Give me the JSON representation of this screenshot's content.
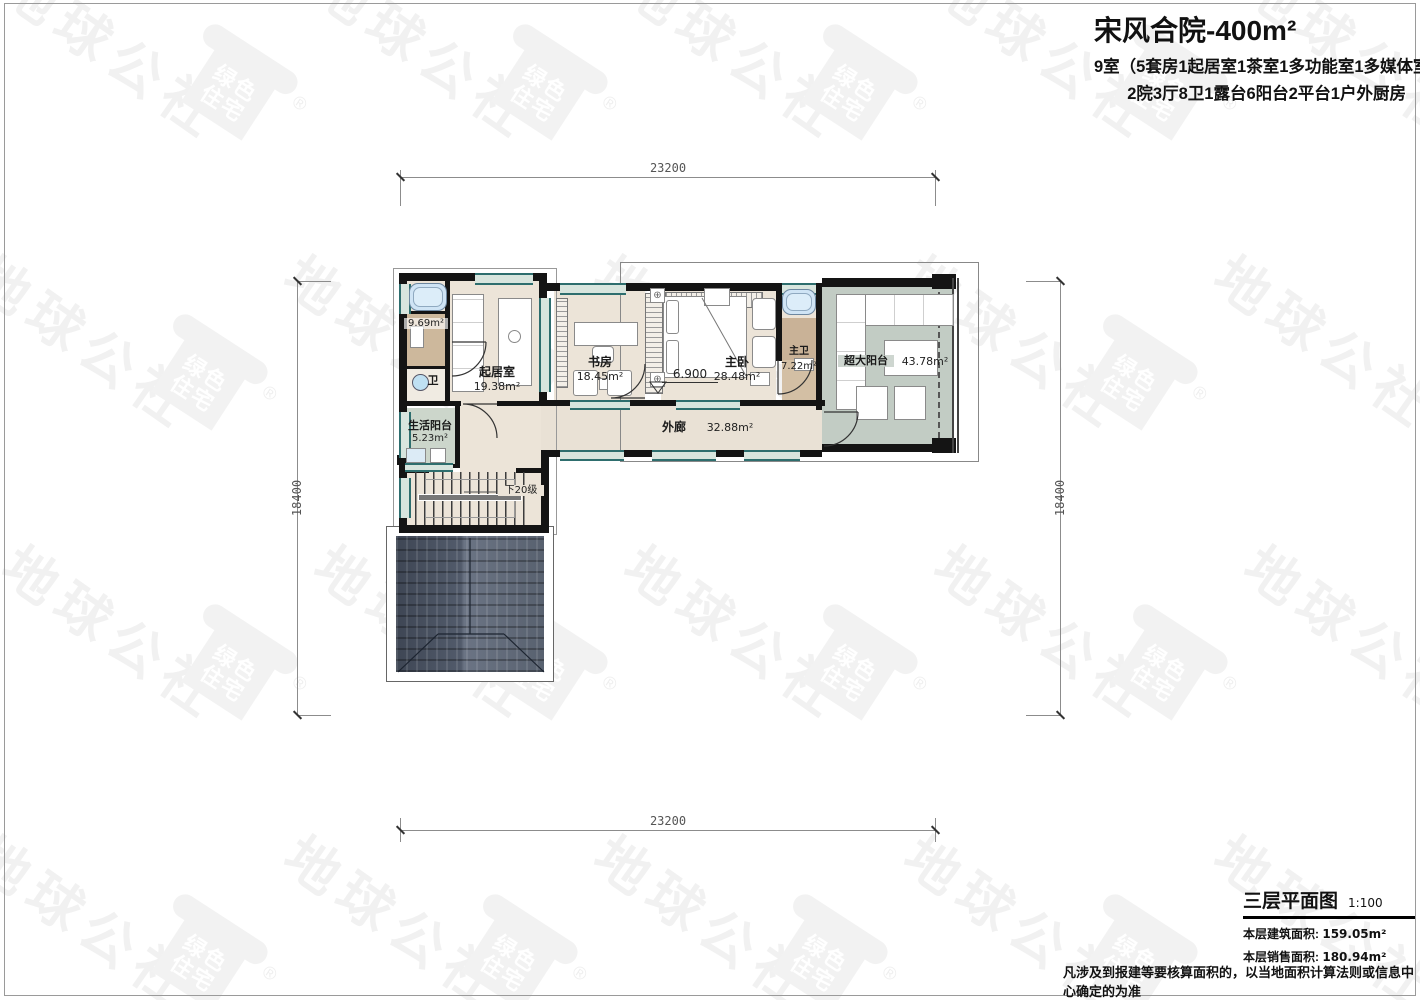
{
  "header": {
    "title": "宋风合院-400m²",
    "subtitle1": "9室（5套房1起居室1茶室1多功能室1多媒体室）",
    "subtitle2": "2院3厅8卫1露台6阳台2平台1户外厨房"
  },
  "plan": {
    "rooms": {
      "living": {
        "name": "起居室",
        "area": "19.38m²"
      },
      "study": {
        "name": "书房",
        "area": "18.45m²"
      },
      "master": {
        "name": "主卧",
        "area": "28.48m²"
      },
      "master_bath": {
        "name": "主卫",
        "area": "7.22m²"
      },
      "bath": {
        "name": "卫",
        "area": "9.69m²"
      },
      "life_balcony": {
        "name": "生活阳台",
        "area": "5.23m²"
      },
      "corridor": {
        "name": "外廊",
        "area": "32.88m²"
      },
      "big_balcony": {
        "name": "超大阳台",
        "area": "43.78m²"
      }
    },
    "level_mark": "6.900",
    "stairs_note": "下20级"
  },
  "dimensions": {
    "top": "23200",
    "bottom": "23200",
    "left": "18400",
    "right": "18400"
  },
  "titleblock": {
    "drawing_name": "三层平面图",
    "scale": "1:100",
    "built_area_label": "本层建筑面积: ",
    "built_area_value": "159.05m²",
    "sales_area_label": "本层销售面积: ",
    "sales_area_value": "180.94m²"
  },
  "footnote": "凡涉及到报建等要核算面积的，以当地面积计算法则或信息中心确定的为准",
  "watermark": {
    "text": "地球公社",
    "logo_line1": "绿色",
    "logo_line2": "住宅",
    "registered": "®"
  }
}
